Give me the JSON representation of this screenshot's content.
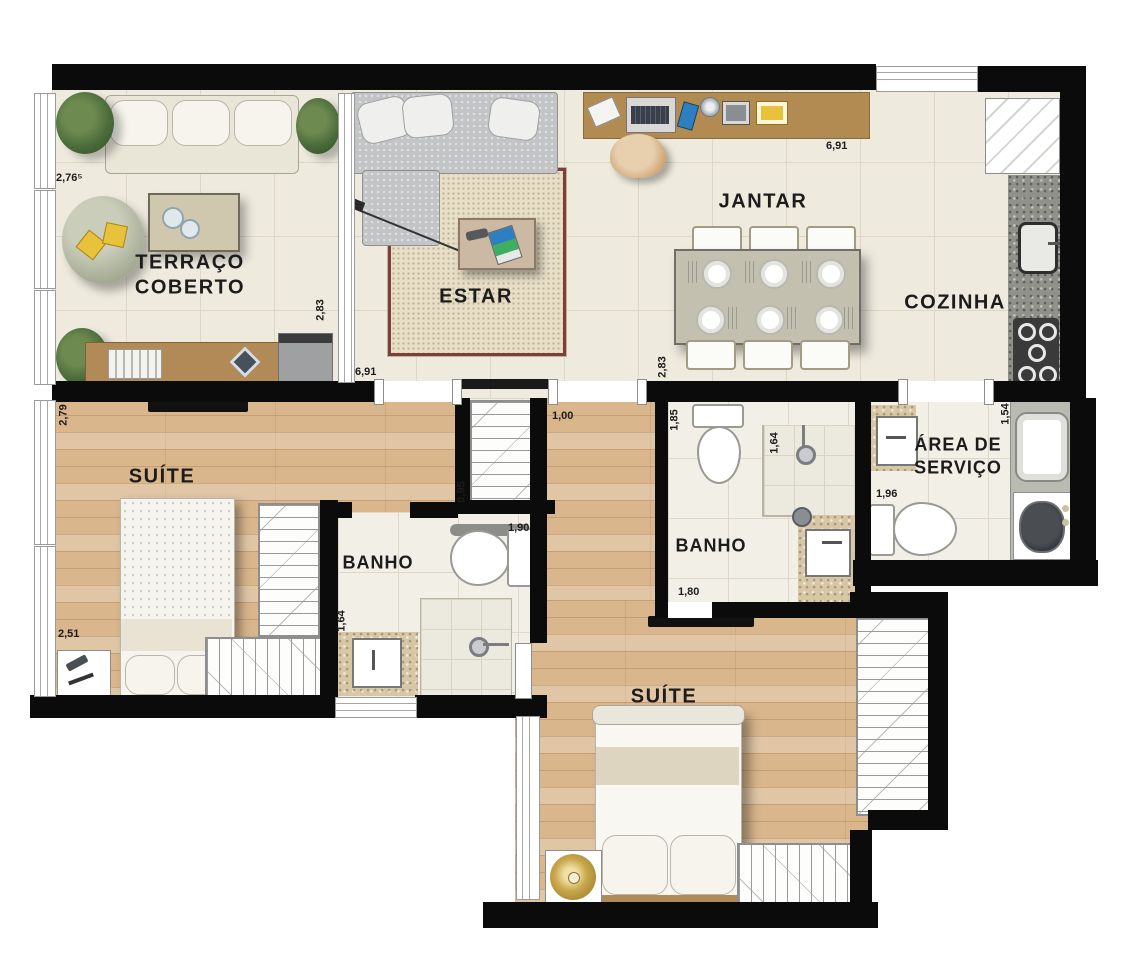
{
  "plan_title": "Apartment floor plan",
  "labels": {
    "terraco1": "TERRAÇO",
    "terraco2": "COBERTO",
    "estar": "ESTAR",
    "jantar": "JANTAR",
    "cozinha": "COZINHA",
    "suite1": "SUÍTE",
    "banho1": "BANHO",
    "banho2": "BANHO",
    "servico1": "ÁREA DE",
    "servico2": "SERVIÇO",
    "suite2": "SUÍTE"
  },
  "dims": {
    "terraco_depth": "2,76⁵",
    "terraco_width": "2,83",
    "living_width": "6,91",
    "living_depth": "2,83",
    "jantar_width": "6,91",
    "suite1_depth": "2,79",
    "suite1_width": "2,51",
    "closet_width": "0,95",
    "hall_width": "1,00",
    "banho1_width": "1,90",
    "banho1_depth": "1,64",
    "banho2_depth": "1,85",
    "banho2_shower": "1,64",
    "banho2_width": "1,80",
    "servico_depth": "1,54",
    "servico_width": "1,96"
  },
  "colors": {
    "wall": "#0b0b0b",
    "wood_floor": "#d9b68c",
    "tile_floor": "#eeeade",
    "granite_counter": "#90918a",
    "beige_granite": "#d7c7a7",
    "rug_border": "#7d3f38",
    "desk_wood": "#b28b52",
    "gold_accent": "#c9a84c",
    "plant_green": "#4a6b3a"
  }
}
